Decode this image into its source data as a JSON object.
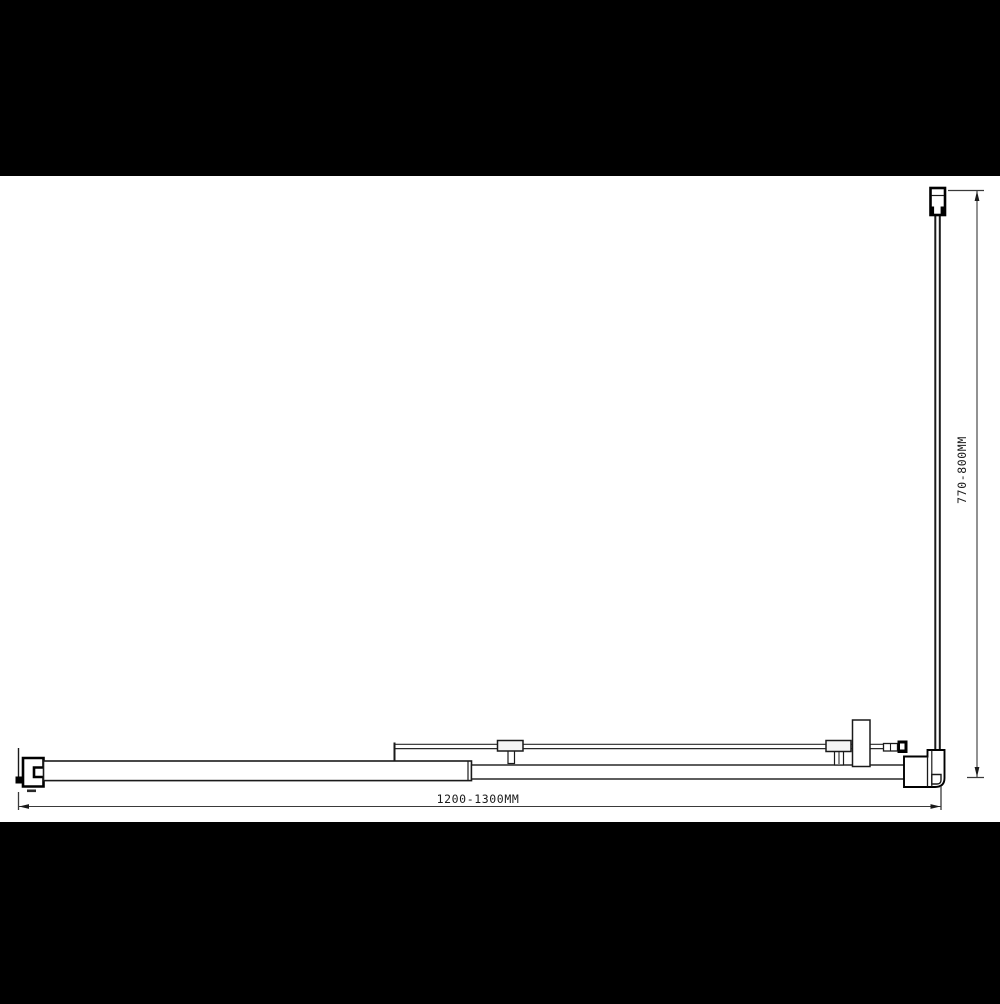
{
  "drawing": {
    "kind": "technical plan-view line drawing",
    "dimensions": {
      "width_label": "1200-1300MM",
      "height_label": "770-800MM"
    }
  },
  "colors": {
    "letterbox": "#000000",
    "canvas": "#ffffff",
    "line": "#1a1a1a",
    "thin_line": "#3a3a3a"
  }
}
